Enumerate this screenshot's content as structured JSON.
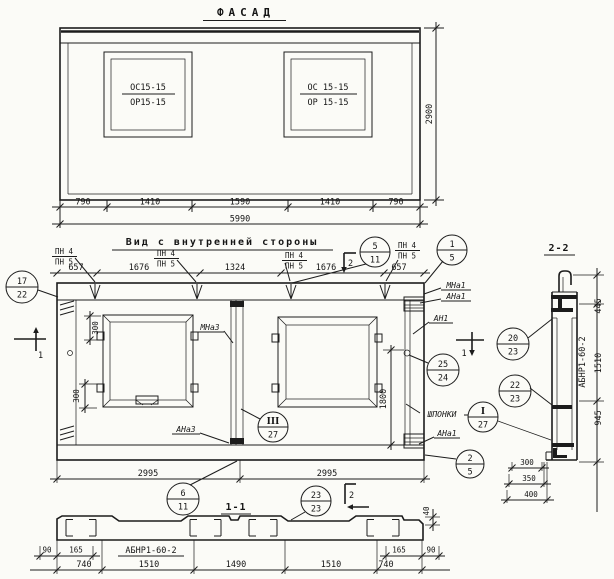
{
  "facade": {
    "title": "ФАСАД",
    "window1": {
      "top": "ОС15-15",
      "bottom": "ОР15-15"
    },
    "window2": {
      "top": "ОС 15-15",
      "bottom": "ОР 15-15"
    },
    "dim_height": "2900",
    "dims": {
      "d790l": "790",
      "d1410l": "1410",
      "d1590": "1590",
      "d1410r": "1410",
      "d790r": "790",
      "total": "5990"
    }
  },
  "inner": {
    "title": "Вид с внутренней стороны",
    "pn": {
      "top": "ПН 4",
      "bottom": "ПН 5"
    },
    "dims_top": {
      "d657l": "657",
      "d1676l": "1676",
      "d1324": "1324",
      "d1676r": "1676",
      "d657r": "657"
    },
    "labels": {
      "mna3": "МНа3",
      "ana3": "АНа3",
      "an1": "АН1",
      "mna1": "МНа1",
      "ana1": "АНа1",
      "ana1_bottom": "АНа1",
      "shponki": "ШПОНКИ"
    },
    "dims": {
      "d300a": "300",
      "d300b": "300",
      "d1800": "1800",
      "d2995l": "2995",
      "d2995r": "2995"
    },
    "section_marks": {
      "s1": "1",
      "s2": "2"
    }
  },
  "callouts": {
    "c17_22": {
      "top": "17",
      "bottom": "22"
    },
    "c5_11": {
      "top": "5",
      "bottom": "11"
    },
    "c1_5": {
      "top": "1",
      "bottom": "5"
    },
    "c25_24": {
      "top": "25",
      "bottom": "24"
    },
    "cIII_27": {
      "top": "III",
      "bottom": "27"
    },
    "cI_27": {
      "top": "I",
      "bottom": "27"
    },
    "c2_5": {
      "top": "2",
      "bottom": "5"
    },
    "c6_11": {
      "top": "6",
      "bottom": "11"
    },
    "c23_23": {
      "top": "23",
      "bottom": "23"
    },
    "c20_23": {
      "top": "20",
      "bottom": "23"
    },
    "c22_23": {
      "top": "22",
      "bottom": "23"
    }
  },
  "section11": {
    "title": "1-1",
    "mark": "АБНР1-60-2",
    "dims": {
      "d40": "40",
      "d90l": "90",
      "d165l": "165",
      "d740l": "740",
      "d1510l": "1510",
      "d1490": "1490",
      "d1510r": "1510",
      "d740r": "740",
      "d165r": "165",
      "d90r": "90"
    }
  },
  "section22": {
    "title": "2-2",
    "mark": "АБНР1-60-2",
    "dims": {
      "d445": "445",
      "d1510": "1510",
      "d945": "945",
      "d300": "300",
      "d350": "350",
      "d400": "400"
    }
  }
}
